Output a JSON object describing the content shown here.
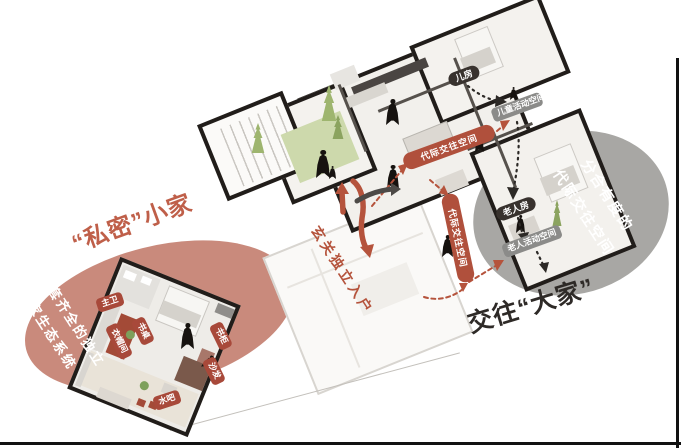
{
  "diagram": {
    "private_home": {
      "title": "“私密”小家",
      "caption_line_1": "配套齐全的独立",
      "caption_line_2": "小家生态系统",
      "rooms": {
        "master_bath": "主卫",
        "cloakroom": "衣帽间",
        "desk": "书桌",
        "bookshelf": "书柜",
        "sofa": "沙发",
        "water_bar": "水吧"
      }
    },
    "social_home": {
      "title": "交往“大家”",
      "caption_line_1": "分合有度的",
      "caption_line_2": "代际交往空间",
      "rooms": {
        "kids_room": "儿房",
        "elder_room": "老人房"
      },
      "activity_spaces": {
        "children": "儿童活动空间",
        "elderly": "老人活动空间"
      }
    },
    "routes": {
      "entry_note": "玄关独立入户",
      "intergen_arrow_1": "代际交往空间",
      "intergen_arrow_2": "代际交往空间"
    },
    "colors": {
      "accent_red": "#b5533c",
      "circle_red": "#c98a7c",
      "circle_gray": "#a8a7a4",
      "pill_dark": "#38322e",
      "pill_gray": "#8b8b89",
      "wall_black": "#211d1a",
      "plant_green": "#9eb56f"
    }
  }
}
